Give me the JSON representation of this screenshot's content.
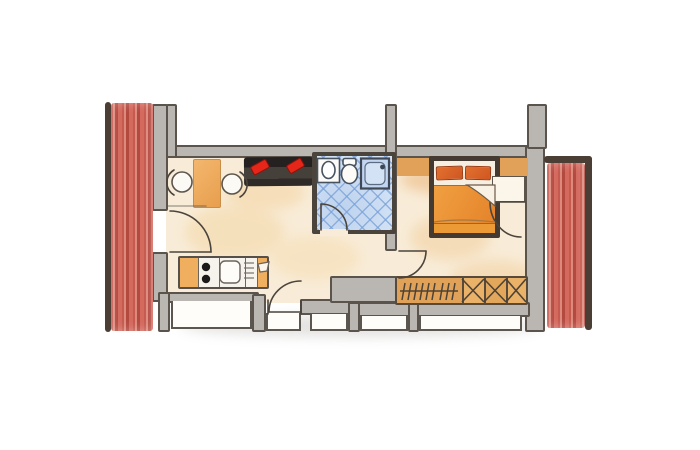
{
  "meta": {
    "type": "hand-drawn apartment floor plan",
    "style": "watercolor pencil sketch",
    "visible_text": "none"
  },
  "palette": {
    "background": "#ffffff",
    "wall_fill": "#bab6b1",
    "wall_line": "#5a544d",
    "floor_cream": "#f8ecd8",
    "floor_wash_orange": "#f2cf9e",
    "curtain_red": "#cf655a",
    "curtain_stripe_dark": "#b34a40",
    "curtain_edge_brown": "#4a3e35",
    "bathroom_tile_blue": "#c3d6f0",
    "fixture_outline_blue": "#47525f",
    "furniture_orange": "#f0ad5e",
    "wardrobe_amber": "#e0a258",
    "bed_frame_brown": "#443a31",
    "bed_blanket_orange": "#ea9335",
    "bed_pillow_orange_red": "#dd6226",
    "sofa_charcoal": "#34302c",
    "sofa_cushion_red": "#e52619",
    "burner_black": "#1d1b19"
  },
  "rooms": {
    "living_kitchen": {
      "label": "Living room with kitchenette",
      "furniture": [
        "dining table",
        "two chairs",
        "sofa with two red cushions",
        "kitchenette"
      ]
    },
    "bathroom": {
      "label": "Bathroom",
      "floor": "blue diamond tiles",
      "fixtures": [
        "washbasin",
        "toilet",
        "shower"
      ]
    },
    "bedroom": {
      "label": "Bedroom",
      "furniture": [
        "double bed with two pillows",
        "headboard shelf",
        "nightstand",
        "wardrobe"
      ]
    }
  },
  "furniture": {
    "table": {
      "label": "dining table"
    },
    "chairs": {
      "label": "chairs",
      "count": 2
    },
    "sofa": {
      "label": "sofa",
      "cushions": 2
    },
    "kitchenette": {
      "label": "kitchenette",
      "burners": 2,
      "parts": [
        "cabinet",
        "stove",
        "sink",
        "drainer",
        "cabinet with cup"
      ]
    },
    "washbasin": {
      "label": "washbasin"
    },
    "toilet": {
      "label": "toilet"
    },
    "shower": {
      "label": "shower"
    },
    "bed": {
      "label": "double bed",
      "pillows": 2
    },
    "nightstand": {
      "label": "nightstand"
    },
    "wardrobe": {
      "label": "wardrobe",
      "hanging_rail_hooks": 9,
      "shelf_compartments": 3
    }
  },
  "openings": {
    "doors": {
      "count": 5,
      "list": [
        "entrance door left",
        "balcony door bottom",
        "bathroom door",
        "bedroom door",
        "bedroom right door swing"
      ]
    },
    "windows": {
      "count": 5
    },
    "curtains": {
      "count": 2,
      "position": [
        "left band",
        "right band"
      ]
    }
  }
}
